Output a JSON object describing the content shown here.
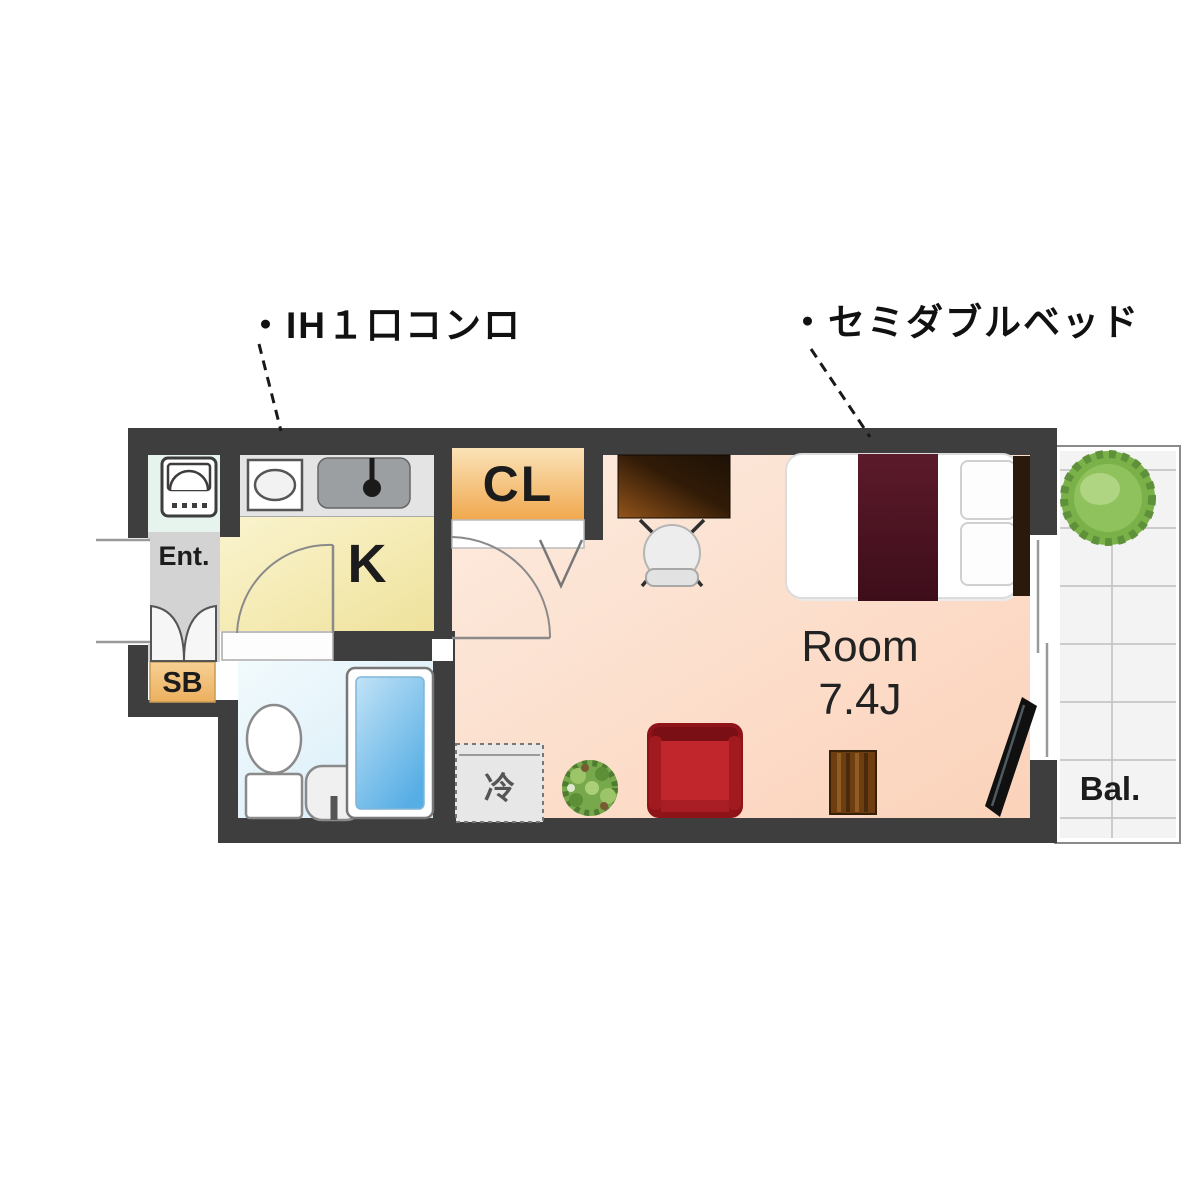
{
  "annotations": {
    "ih_stove": "・IH１口コンロ",
    "semi_double_bed": "・セミダブルベッド"
  },
  "plan": {
    "entrance_label": "Ent.",
    "shoe_box_label": "SB",
    "kitchen_label": "K",
    "closet_label": "CL",
    "room_label": "Room",
    "room_size": "7.4J",
    "balcony_label": "Bal.",
    "refrigerator_label": "冷"
  },
  "colors": {
    "wall": "#3e3e3e",
    "room_floor": "#fcdcc4",
    "kitchen_floor": "#f4ebaf",
    "bathroom_floor": "#e0eff8",
    "closet": "#f3b261",
    "shoe_box": "#f0bd74",
    "entrance_floor": "#d3d3d3",
    "counter": "#e4e4e4",
    "balcony_floor": "#f3f3f3",
    "bathtub": "#63b2e4",
    "sofa": "#c0262c",
    "bed_blanket": "#4d1322",
    "bed_headboard": "#2b1a0b",
    "desk": "#54300e",
    "tree": "#7ab148",
    "tv": "#101010",
    "leader_line": "#191919"
  }
}
